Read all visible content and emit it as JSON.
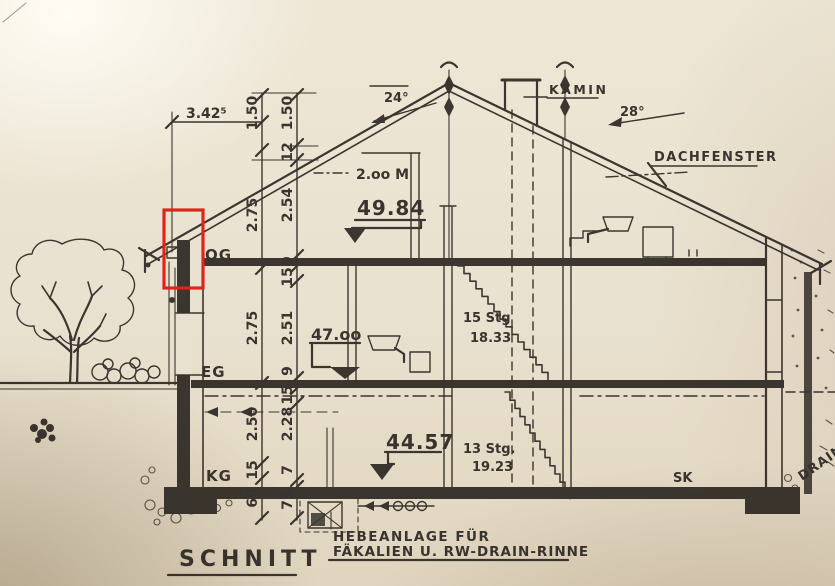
{
  "drawing": {
    "title": "SCHNITT",
    "labels": {
      "kamin": "KAMIN",
      "dachfenster": "DACHFENSTER",
      "angle_left": "24°",
      "angle_right": "28°",
      "headroom": "2.oo M",
      "floor_og": "OG",
      "floor_eg": "EG",
      "floor_kg": "KG",
      "sk": "SK",
      "drain": "DRAIN"
    },
    "elevations": {
      "attic": "49.84",
      "og": "47.oo",
      "kg": "44.57"
    },
    "stairs": {
      "upper": {
        "count": "15 Stg",
        "value": "18.33"
      },
      "lower": {
        "count": "13 Stg.",
        "value": "19.23"
      }
    },
    "note": {
      "line1": "HEBEANLAGE FÜR",
      "line2": "FÄKALIEN U. RW-DRAIN-RINNE"
    },
    "dimensions": {
      "top_width": "3.42⁵",
      "chain_outer": [
        "1.50",
        "2.75",
        "2.75",
        "2.50",
        "15",
        "60"
      ],
      "chain_inner": [
        "1.50",
        "12",
        "2.54",
        "9",
        "15",
        "2.51",
        "9",
        "15",
        "2.28",
        "7",
        "75"
      ]
    },
    "annotation_color": "#e0241c"
  }
}
